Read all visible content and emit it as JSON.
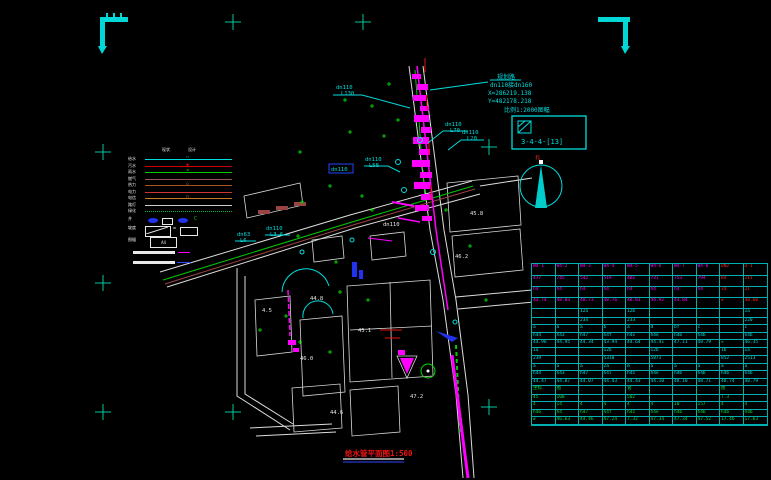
{
  "colors": {
    "background": "#000000",
    "cyan": "#00dddd",
    "magenta": "#ff00ff",
    "green": "#00cc00",
    "red": "#ee1111",
    "white": "#e8e8e8",
    "cross": "#00c8a0",
    "table_grid": "#00b0b0"
  },
  "annotations": {
    "road_name": "规划路",
    "pipe_note": "dn110接dn160",
    "coord_x": "X=286219.138",
    "coord_y": "Y=482178.218",
    "scale_note": "比例1:2000图幅",
    "sheet_no": "3-4-4-[13]",
    "north": "北",
    "title": "给水管平面图1:500"
  },
  "legend": {
    "headers": [
      "现状",
      "设计"
    ],
    "sym_label": "井",
    "sym_char": "C",
    "slope_label": "坡度",
    "eq": "=",
    "frame_label": "图幅",
    "frame_text": "A4",
    "rows": [
      {
        "label": "给水",
        "color": "#00dddd",
        "style": "solid",
        "sym": "◠"
      },
      {
        "label": "污水",
        "color": "#cc0000",
        "style": "solid",
        "sym": "◆"
      },
      {
        "label": "雨水",
        "color": "#00cc00",
        "style": "solid",
        "sym": "≏"
      },
      {
        "label": "燃气",
        "color": "#995555",
        "style": "solid",
        "sym": ""
      },
      {
        "label": "热力",
        "color": "#aa5522",
        "style": "solid",
        "sym": "◇"
      },
      {
        "label": "电力",
        "color": "#cc3333",
        "style": "solid",
        "sym": ""
      },
      {
        "label": "电信",
        "color": "#cc7722",
        "style": "solid",
        "sym": "○"
      },
      {
        "label": "路灯",
        "color": "#cccccc",
        "style": "solid",
        "sym": ""
      },
      {
        "label": "绿化",
        "color": "#00bb44",
        "style": "dotted",
        "sym": ""
      }
    ]
  },
  "map": {
    "crosses": [
      [
        233,
        22
      ],
      [
        363,
        22
      ],
      [
        103,
        152
      ],
      [
        103,
        283
      ],
      [
        103,
        412
      ],
      [
        233,
        412
      ],
      [
        489,
        147
      ],
      [
        489,
        407
      ]
    ],
    "green_marks": [
      [
        300,
        152
      ],
      [
        345,
        100
      ],
      [
        372,
        106
      ],
      [
        389,
        84
      ],
      [
        350,
        132
      ],
      [
        384,
        136
      ],
      [
        302,
        202
      ],
      [
        330,
        186
      ],
      [
        362,
        196
      ],
      [
        298,
        236
      ],
      [
        336,
        262
      ],
      [
        372,
        210
      ],
      [
        398,
        120
      ],
      [
        340,
        292
      ],
      [
        368,
        300
      ],
      [
        300,
        342
      ],
      [
        330,
        352
      ],
      [
        286,
        316
      ],
      [
        260,
        330
      ],
      [
        446,
        210
      ],
      [
        470,
        246
      ],
      [
        486,
        300
      ]
    ],
    "magenta_blocks": [
      [
        412,
        74,
        9,
        5
      ],
      [
        417,
        84,
        11,
        6
      ],
      [
        413,
        95,
        13,
        6
      ],
      [
        420,
        106,
        9,
        5
      ],
      [
        414,
        115,
        15,
        7
      ],
      [
        421,
        127,
        10,
        6
      ],
      [
        413,
        137,
        16,
        7
      ],
      [
        419,
        149,
        11,
        6
      ],
      [
        412,
        160,
        18,
        7
      ],
      [
        420,
        172,
        12,
        6
      ],
      [
        414,
        182,
        16,
        7
      ],
      [
        421,
        194,
        11,
        6
      ],
      [
        415,
        205,
        14,
        6
      ],
      [
        422,
        216,
        10,
        5
      ],
      [
        288,
        340,
        8,
        5
      ],
      [
        293,
        348,
        6,
        4
      ],
      [
        398,
        350,
        7,
        5
      ]
    ],
    "maroon_blocks": [
      [
        258,
        210,
        12,
        4
      ],
      [
        276,
        206,
        12,
        4
      ],
      [
        294,
        202,
        12,
        4
      ]
    ],
    "labels": [
      {
        "t": "dn110",
        "x": 336,
        "y": 89,
        "c": "#00dddd"
      },
      {
        "t": "L130",
        "x": 341,
        "y": 95,
        "c": "#00dddd"
      },
      {
        "t": "dn110",
        "x": 445,
        "y": 126,
        "c": "#00dddd"
      },
      {
        "t": "L70",
        "x": 450,
        "y": 132,
        "c": "#00dddd"
      },
      {
        "t": "dn110",
        "x": 462,
        "y": 134,
        "c": "#00dddd"
      },
      {
        "t": "L20",
        "x": 467,
        "y": 140,
        "c": "#00dddd"
      },
      {
        "t": "dn110",
        "x": 365,
        "y": 161,
        "c": "#00dddd"
      },
      {
        "t": "L58",
        "x": 369,
        "y": 167,
        "c": "#00dddd"
      },
      {
        "t": "dn110",
        "x": 331,
        "y": 171,
        "c": "#00dddd"
      },
      {
        "t": "dn63",
        "x": 237,
        "y": 236,
        "c": "#00dddd"
      },
      {
        "t": "L6",
        "x": 240,
        "y": 242,
        "c": "#00dddd"
      },
      {
        "t": "dn110",
        "x": 266,
        "y": 230,
        "c": "#00dddd"
      },
      {
        "t": "L3.6",
        "x": 270,
        "y": 236,
        "c": "#00dddd"
      },
      {
        "t": "dn110",
        "x": 383,
        "y": 226,
        "c": "#e8e8e8"
      },
      {
        "t": "44.8",
        "x": 310,
        "y": 300,
        "c": "#e8e8e8"
      },
      {
        "t": "45.1",
        "x": 358,
        "y": 332,
        "c": "#e8e8e8"
      },
      {
        "t": "46.0",
        "x": 300,
        "y": 360,
        "c": "#e8e8e8"
      },
      {
        "t": "44.6",
        "x": 330,
        "y": 414,
        "c": "#e8e8e8"
      },
      {
        "t": "47.2",
        "x": 410,
        "y": 398,
        "c": "#e8e8e8"
      },
      {
        "t": "4.5",
        "x": 262,
        "y": 312,
        "c": "#e8e8e8"
      },
      {
        "t": "46.2",
        "x": 455,
        "y": 258,
        "c": "#e8e8e8"
      },
      {
        "t": "45.8",
        "x": 470,
        "y": 215,
        "c": "#e8e8e8"
      }
    ]
  },
  "table": {
    "groups": [
      {
        "color": "#ff00ff",
        "row_h": 11,
        "col_colors": {
          "8": "#ff2222",
          "9": "#ff2222"
        },
        "rows": [
          [
            "W4-1",
            "W4-2",
            "W4-3",
            "W4-4",
            "W4-5",
            "W4-6",
            "W4-7",
            "W4-8",
            "DN2",
            "D-1"
          ],
          [
            "477",
            "745",
            "542",
            "519",
            "481",
            "731",
            "753",
            "794",
            "84",
            "211"
          ],
          [
            "h4",
            "h4",
            "h4",
            "h4",
            "h4",
            "h4",
            "h4",
            "h4",
            "34",
            "21"
          ],
          [
            "43.74",
            "48.83",
            "48.73",
            "48.76",
            "48.81",
            "44.92",
            "44.84",
            "",
            "≠",
            "48.60"
          ]
        ]
      },
      {
        "color": "#00dddd",
        "row_h": 7.5,
        "rows": [
          [
            "",
            "",
            "12a",
            "",
            "12b",
            "",
            "",
            "",
            "",
            "1a"
          ],
          [
            "",
            "",
            "234",
            "",
            "233",
            "",
            "",
            "",
            "",
            "220"
          ],
          [
            "a",
            "a",
            "a",
            "b",
            "a",
            "d",
            "bf",
            "c",
            "",
            "c"
          ],
          [
            "h44",
            "h43",
            "h47",
            "h4f",
            "h4x",
            "h4e",
            "h4b",
            "h4b",
            "",
            "h4b"
          ],
          [
            "44.96",
            "44.95",
            "44.34",
            "43.94",
            "44.64",
            "44.41",
            "47.11",
            "48.79",
            "≈",
            "46.35"
          ]
        ]
      },
      {
        "color": "#00dddd",
        "row_h": 7.5,
        "rows": [
          [
            "1a",
            "",
            "",
            "12b",
            "",
            "12b",
            "",
            "",
            "1b",
            "1a"
          ],
          [
            "239",
            "",
            "",
            "5310",
            "",
            "5871",
            "",
            "",
            "852",
            "2513"
          ],
          [
            "a",
            "a",
            "a",
            "2a",
            "m",
            "a",
            "a",
            "a",
            "a",
            "a"
          ],
          [
            "h44",
            "h43",
            "h47",
            "h4l",
            "h4z",
            "h4e",
            "h4b",
            "h4b",
            "h4b",
            "h4b"
          ],
          [
            "44.47",
            "44.87",
            "44.07",
            "44.43",
            "44.43",
            "44.10",
            "48.10",
            "48.71",
            "48.74",
            "48.79"
          ]
        ]
      },
      {
        "color": "#00dd44",
        "row_h": 7.5,
        "rows": [
          [
            "坐标",
            "图",
            "",
            "",
            "管",
            "",
            "",
            "",
            "图",
            ""
          ],
          [
            "45",
            "100",
            "",
            "",
            "502",
            "",
            "",
            "",
            "7.3",
            ""
          ],
          [
            "4",
            "14",
            "4",
            "4",
            "4",
            "4",
            "10",
            "157",
            "4",
            "4"
          ],
          [
            "h4b",
            "h4",
            "h47",
            "h4f",
            "h4z",
            "h4e",
            "h4b",
            "h4b",
            "h4b",
            "h4b"
          ],
          [
            "≠",
            "46.63",
            "44.46",
            "47.24",
            "7.32",
            "47.34",
            "47.34",
            "47.52",
            "17.46",
            "17.63"
          ]
        ]
      }
    ]
  }
}
